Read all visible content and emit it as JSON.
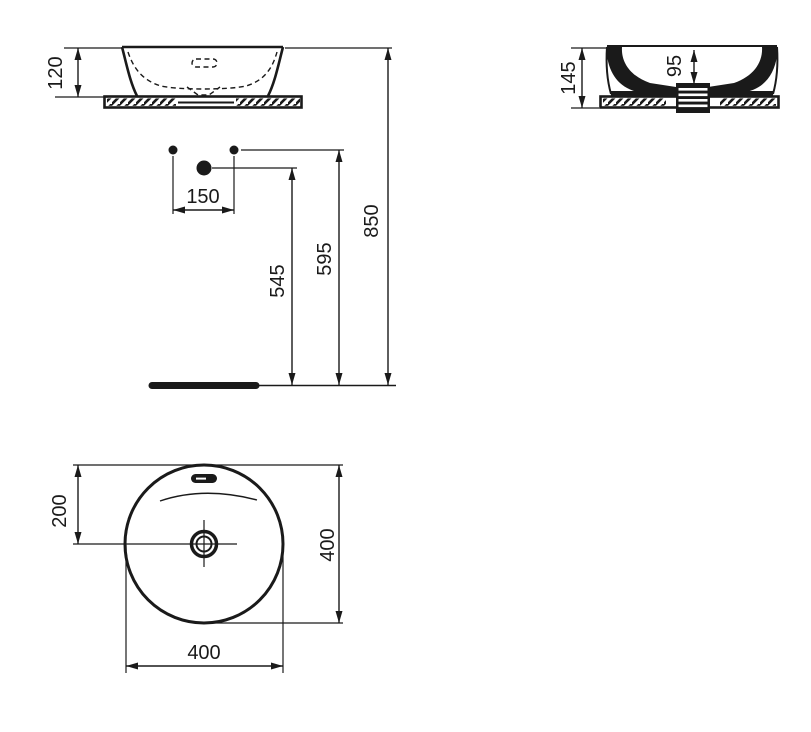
{
  "page": {
    "background": "#ffffff",
    "line_color": "#1a1a1a"
  },
  "views": {
    "front": {
      "basin_height_mm": "120"
    },
    "side": {
      "overall_height_mm": "145",
      "bowl_depth_mm": "95"
    },
    "install": {
      "tap_hole_spacing_mm": "150",
      "waste_outlet_height_mm": "545",
      "supply_height_mm": "595",
      "rim_height_mm": "850"
    },
    "plan": {
      "rim_to_center_mm": "200",
      "diameter_vertical_mm": "400",
      "diameter_horizontal_mm": "400"
    }
  }
}
